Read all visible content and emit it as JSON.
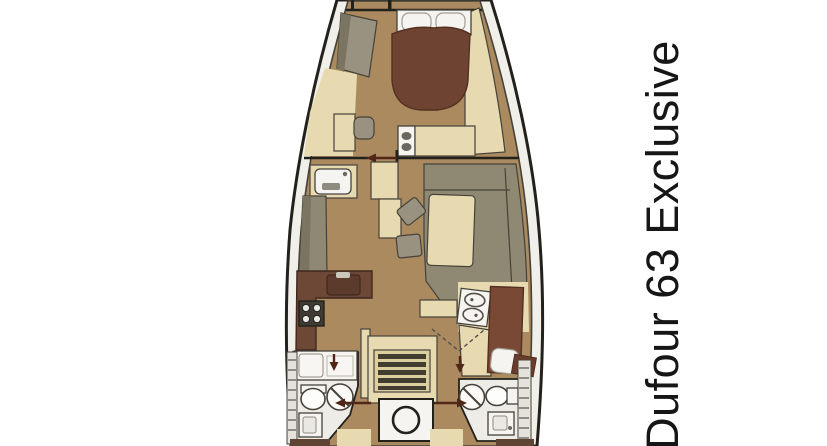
{
  "title": {
    "text": "Dufour 63 Exclusive"
  },
  "colors": {
    "background": "#ffffff",
    "deck": "#f0efea",
    "outline": "#23211c",
    "inner_line": "#45423a",
    "floor": "#aa8a5e",
    "cream": "#e8dab0",
    "cream_dark": "#dccf9f",
    "bed_brown": "#6f4332",
    "berth_brown": "#7a4936",
    "counter_brown": "#6d4837",
    "counter_sink": "#5c3b2d",
    "sofa_olive": "#8f8872",
    "sofa_olive_dark": "#7b7460",
    "gray_furniture": "#9a9280",
    "white_fixture": "#f5f4f0",
    "steps_dark": "#433d31",
    "arrow": "#502616",
    "hatch": "#55514a",
    "text_color": "#161616"
  },
  "icons": {
    "boat_floorplan": "top-down yacht layout",
    "island_bed": "double bed with pillows",
    "toilet": "toilet oval",
    "shower": "circle with diagonal",
    "stove": "four burner cooktop",
    "stairs": "companionway ladder",
    "engine_hatch": "round hatch",
    "door_arrow": "door direction arrow"
  }
}
